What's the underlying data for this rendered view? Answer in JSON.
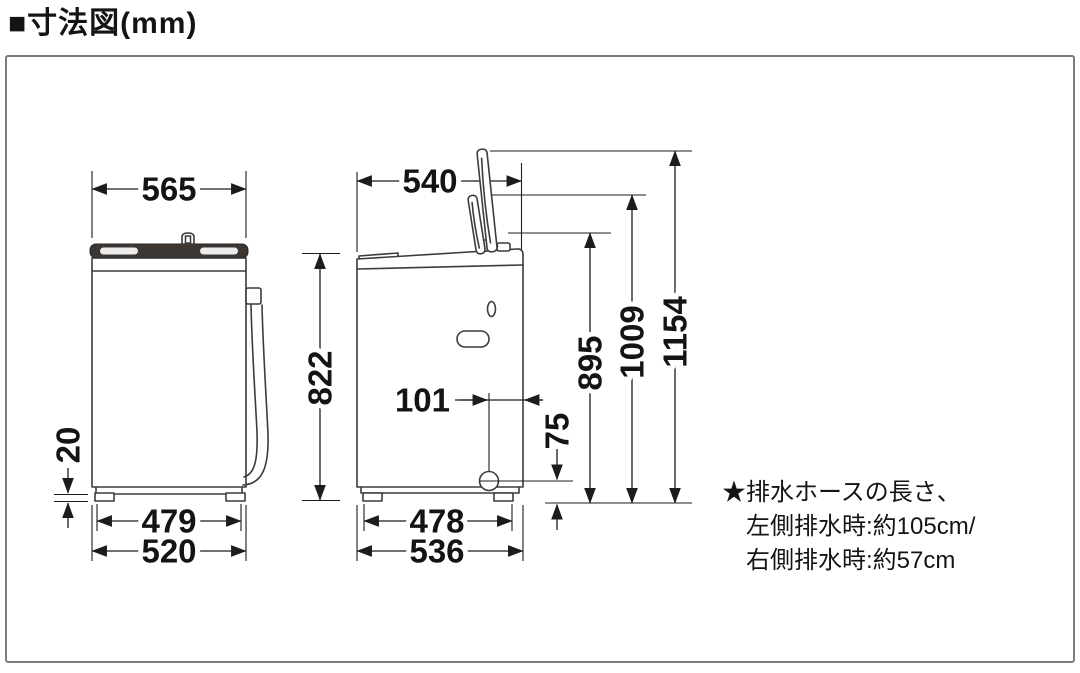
{
  "title": "■寸法図(mm)",
  "unit": "mm",
  "front_view": {
    "top_width": "565",
    "foot_height": "20",
    "feet_span": "479",
    "body_width": "520"
  },
  "side_view": {
    "top_depth": "540",
    "body_height": "822",
    "drain_to_rear": "101",
    "drain_height": "75",
    "height_body_top": "895",
    "height_lid_folded": "1009",
    "height_lid_open": "1154",
    "feet_span": "478",
    "body_depth": "536"
  },
  "note": {
    "line1": "★排水ホースの長さ、",
    "line2": "左側排水時:約105cm/",
    "line3": "右側排水時:約57cm"
  },
  "colors": {
    "line": "#3c3c3c",
    "dimension": "#1c1c1c",
    "lid_bar_fill": "#3d3734",
    "border": "#7d7d7d",
    "background": "#ffffff"
  }
}
